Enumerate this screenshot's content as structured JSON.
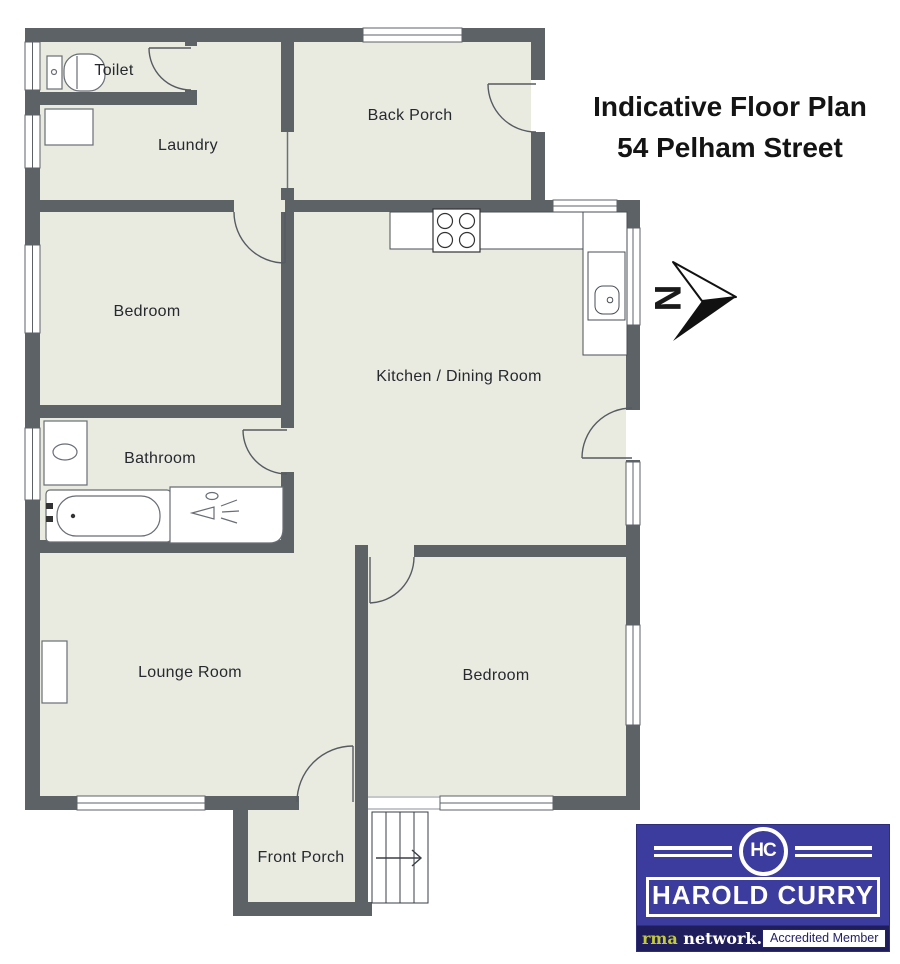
{
  "title": {
    "line1": "Indicative Floor Plan",
    "line2": "54 Pelham Street"
  },
  "rooms": [
    {
      "label": "Toilet"
    },
    {
      "label": "Laundry"
    },
    {
      "label": "Back Porch"
    },
    {
      "label": "Bedroom"
    },
    {
      "label": "Kitchen / Dining Room"
    },
    {
      "label": "Bathroom"
    },
    {
      "label": "Lounge Room"
    },
    {
      "label": "Bedroom"
    },
    {
      "label": "Front Porch"
    }
  ],
  "compass": {
    "letter": "N"
  },
  "logo": {
    "monogram": "HC",
    "name": "HAROLD CURRY",
    "network_bold": "rma",
    "network_rest": " network.",
    "accredited": "Accredited Member"
  },
  "colors": {
    "wall": "#5d6267",
    "floor": "#e9ebe1",
    "logo_blue": "#3c3b9e",
    "bar_navy": "#201d5c",
    "rma_yellow": "#c3ca39"
  }
}
